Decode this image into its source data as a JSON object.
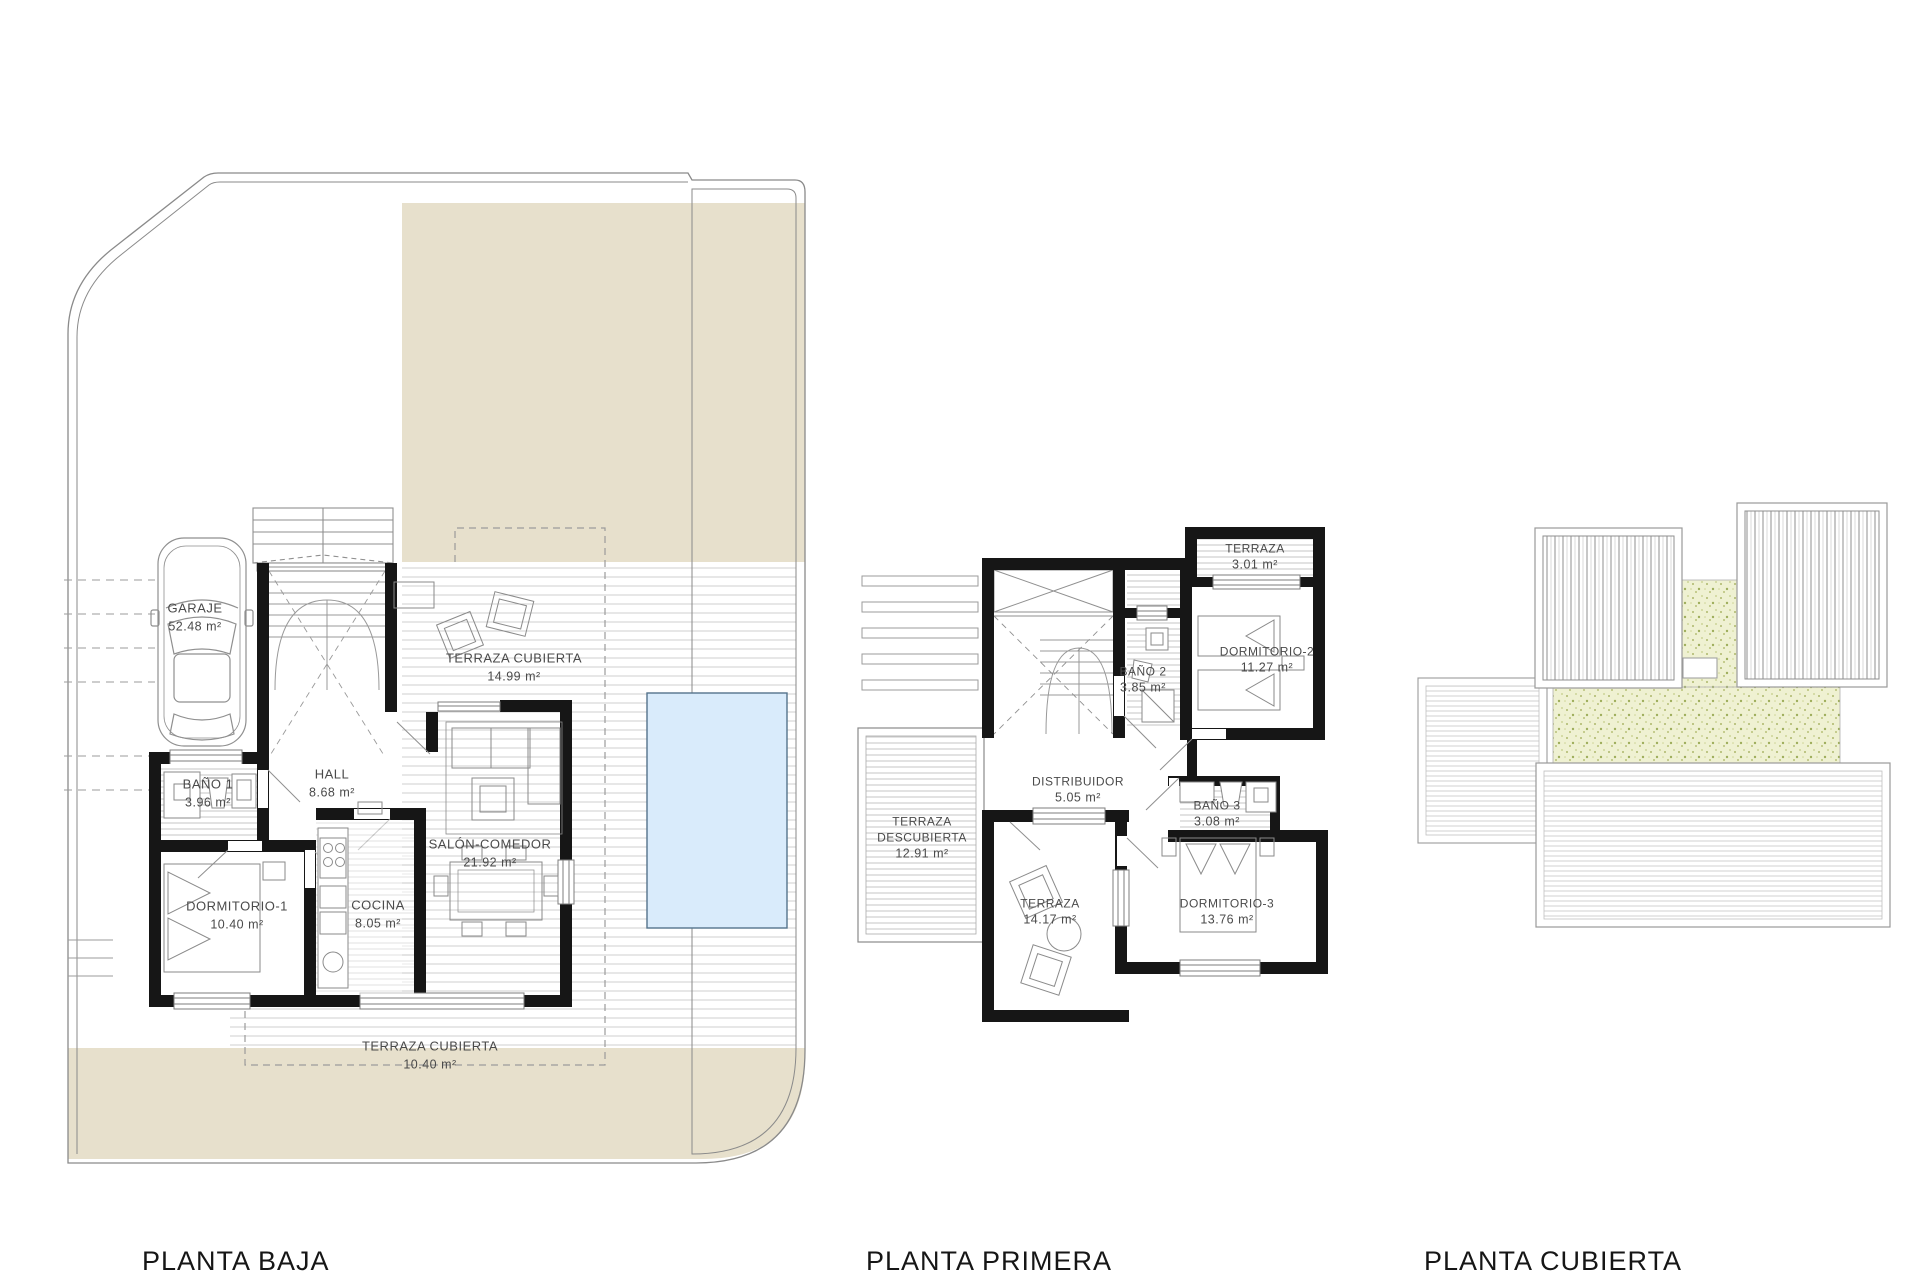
{
  "sheet": {
    "type": "architectural floor plans",
    "colors": {
      "plot_beige": "#e7e0cc",
      "pool_blue": "#d9ebfb",
      "pool_border": "#54738c",
      "roof_grass_green": "#eff1d2",
      "wall_black": "#161616",
      "line_gray": "#8a8a8a",
      "hatch_gray": "#cfcfcf"
    }
  },
  "plans": {
    "ground": {
      "caption": "PLANTA BAJA",
      "rooms": {
        "garaje": {
          "name": "GARAJE",
          "area": "52.48 m²"
        },
        "bano1": {
          "name": "BAÑO 1",
          "area": "3.96 m²"
        },
        "hall": {
          "name": "HALL",
          "area": "8.68 m²"
        },
        "dormitorio1": {
          "name": "DORMITORIO-1",
          "area": "10.40 m²"
        },
        "cocina": {
          "name": "COCINA",
          "area": "8.05 m²"
        },
        "salon_comedor": {
          "name": "SALÓN-COMEDOR",
          "area": "21.92 m²"
        },
        "terraza_cubierta1": {
          "name": "TERRAZA CUBIERTA",
          "area": "14.99 m²"
        },
        "terraza_cubierta2": {
          "name": "TERRAZA CUBIERTA",
          "area": "10.40 m²"
        }
      }
    },
    "first": {
      "caption": "PLANTA PRIMERA",
      "rooms": {
        "terraza_sup": {
          "name": "TERRAZA",
          "area": "3.01 m²"
        },
        "dormitorio2": {
          "name": "DORMITORIO-2",
          "area": "11.27 m²"
        },
        "bano2": {
          "name": "BAÑO 2",
          "area": "3.85 m²"
        },
        "distribuidor": {
          "name": "DISTRIBUIDOR",
          "area": "5.05 m²"
        },
        "bano3": {
          "name": "BAÑO 3",
          "area": "3.08 m²"
        },
        "terraza_descubierta": {
          "name_line1": "TERRAZA",
          "name_line2": "DESCUBIERTA",
          "area": "12.91 m²"
        },
        "terraza_inf": {
          "name": "TERRAZA",
          "area": "14.17 m²"
        },
        "dormitorio3": {
          "name": "DORMITORIO-3",
          "area": "13.76 m²"
        }
      }
    },
    "roof": {
      "caption": "PLANTA CUBIERTA"
    }
  }
}
